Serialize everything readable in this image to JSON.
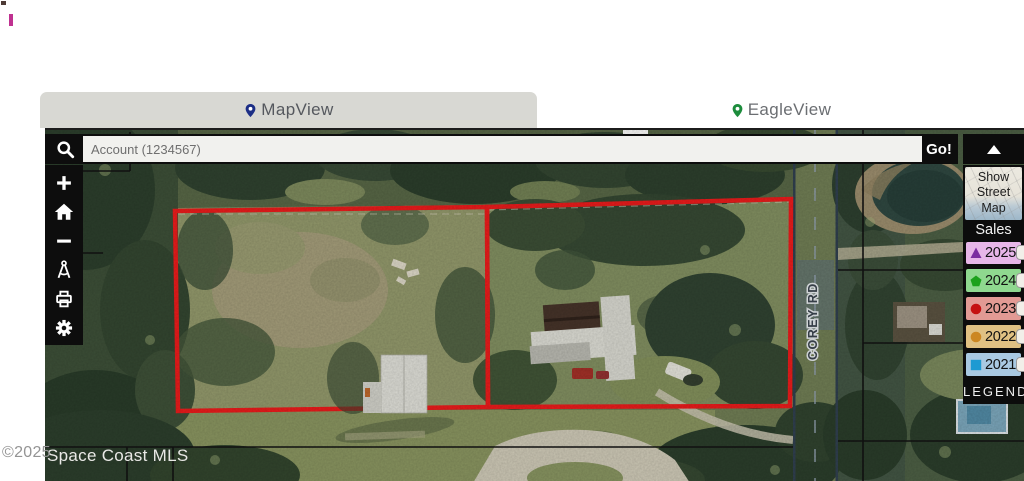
{
  "window": {
    "background": "#ffffff"
  },
  "decorations": {
    "top_left_square_color": "#4d3a35",
    "top_left_bar_color": "#bf3190"
  },
  "tabs": {
    "map_view": {
      "label": "MapView",
      "pin_color": "#1c2e86"
    },
    "eagle_view": {
      "label": "EagleView",
      "pin_color": "#1c8c3c"
    }
  },
  "search": {
    "placeholder": "Account (1234567)",
    "go_label": "Go!"
  },
  "toolbar": {
    "items": [
      {
        "icon": "plus-icon",
        "action": "zoom-in"
      },
      {
        "icon": "home-icon",
        "action": "home"
      },
      {
        "icon": "minus-icon",
        "action": "zoom-out"
      },
      {
        "icon": "measure-icon",
        "action": "measure"
      },
      {
        "icon": "printer-icon",
        "action": "print"
      },
      {
        "icon": "gear-icon",
        "action": "settings"
      }
    ]
  },
  "right_panel": {
    "collapse_icon": "chevron-up",
    "street_map_button": {
      "line1": "Show",
      "line2": "Street",
      "line3": "Map"
    },
    "sales_title": "Sales",
    "years": [
      {
        "label": "2025",
        "marker": "triangle",
        "marker_color": "#7b2da0",
        "row_color": "#e7b6e8",
        "checked": false
      },
      {
        "label": "2024",
        "marker": "pentagon",
        "marker_color": "#1ca11c",
        "row_color": "#8fd88f",
        "checked": false
      },
      {
        "label": "2023",
        "marker": "circle",
        "marker_color": "#c51111",
        "row_color": "#e29a94",
        "checked": false
      },
      {
        "label": "2022",
        "marker": "circle",
        "marker_color": "#cc8722",
        "row_color": "#e0c183",
        "checked": false
      },
      {
        "label": "2021",
        "marker": "square",
        "marker_color": "#1e9ad2",
        "row_color": "#a9c9e2",
        "checked": false
      }
    ],
    "legend_label": "LEGEND"
  },
  "map": {
    "street_label": "COREY RD",
    "watermark_prefix": "©2025",
    "watermark_text": "Space Coast MLS",
    "parcel_outline_color": "#e41b1b",
    "road_color": "#4a5a6c"
  }
}
